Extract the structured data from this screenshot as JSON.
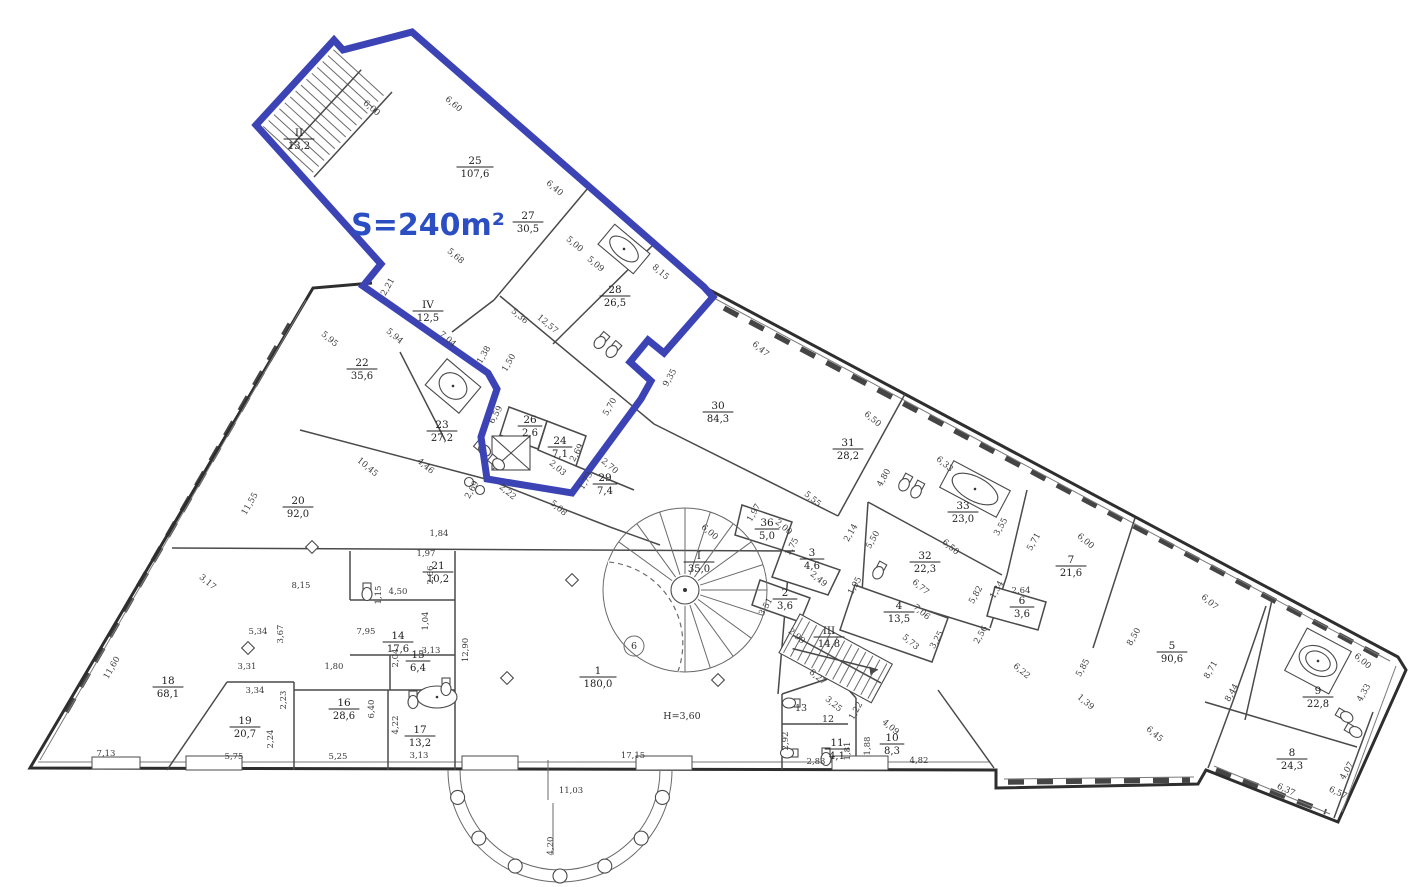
{
  "highlight": {
    "label": "S=240m²"
  },
  "colors": {
    "highlight": "#3c43b5",
    "highlight_text": "#2b4fc2",
    "walls": "#2e2e2e",
    "labels": "#222222"
  },
  "icons": [
    "spiral-staircase",
    "staircase",
    "elevator",
    "bathtub",
    "toilet",
    "sink",
    "column",
    "colonnade"
  ],
  "rooms": [
    {
      "num": "II",
      "area": "13,2",
      "x": 299,
      "y": 140
    },
    {
      "num": "25",
      "area": "107,6",
      "x": 475,
      "y": 168
    },
    {
      "num": "27",
      "area": "30,5",
      "x": 528,
      "y": 223
    },
    {
      "num": "28",
      "area": "26,5",
      "x": 615,
      "y": 297
    },
    {
      "num": "IV",
      "area": "12,5",
      "x": 428,
      "y": 312
    },
    {
      "num": "22",
      "area": "35,6",
      "x": 362,
      "y": 370
    },
    {
      "num": "23",
      "area": "27,2",
      "x": 442,
      "y": 432
    },
    {
      "num": "26",
      "area": "2,6",
      "x": 530,
      "y": 427
    },
    {
      "num": "24",
      "area": "7,1",
      "x": 560,
      "y": 448
    },
    {
      "num": "29",
      "area": "7,4",
      "x": 605,
      "y": 485
    },
    {
      "num": "30",
      "area": "84,3",
      "x": 718,
      "y": 413
    },
    {
      "num": "31",
      "area": "28,2",
      "x": 848,
      "y": 450
    },
    {
      "num": "33",
      "area": "23,0",
      "x": 963,
      "y": 513
    },
    {
      "num": "32",
      "area": "22,3",
      "x": 925,
      "y": 563
    },
    {
      "num": "7",
      "area": "21,6",
      "x": 1071,
      "y": 567
    },
    {
      "num": "6",
      "area": "3,6",
      "x": 1022,
      "y": 608
    },
    {
      "num": "4",
      "area": "13,5",
      "x": 899,
      "y": 613
    },
    {
      "num": "5",
      "area": "90,6",
      "x": 1172,
      "y": 653
    },
    {
      "num": "9",
      "area": "22,8",
      "x": 1318,
      "y": 698
    },
    {
      "num": "8",
      "area": "24,3",
      "x": 1292,
      "y": 760
    },
    {
      "num": "3",
      "area": "4,6",
      "x": 812,
      "y": 560
    },
    {
      "num": "2",
      "area": "3,6",
      "x": 785,
      "y": 600
    },
    {
      "num": "36",
      "area": "5,0",
      "x": 767,
      "y": 530
    },
    {
      "num": "I",
      "area": "35,0",
      "x": 699,
      "y": 563
    },
    {
      "num": "III",
      "area": "14,8",
      "x": 829,
      "y": 638
    },
    {
      "num": "1",
      "area": "180,0",
      "x": 598,
      "y": 678
    },
    {
      "num": "20",
      "area": "92,0",
      "x": 298,
      "y": 508
    },
    {
      "num": "21",
      "area": "10,2",
      "x": 438,
      "y": 573
    },
    {
      "num": "14",
      "area": "17,6",
      "x": 398,
      "y": 643
    },
    {
      "num": "15",
      "area": "6,4",
      "x": 418,
      "y": 662
    },
    {
      "num": "18",
      "area": "68,1",
      "x": 168,
      "y": 688
    },
    {
      "num": "19",
      "area": "20,7",
      "x": 245,
      "y": 728
    },
    {
      "num": "16",
      "area": "28,6",
      "x": 344,
      "y": 710
    },
    {
      "num": "17",
      "area": "13,2",
      "x": 420,
      "y": 737
    },
    {
      "num": "11",
      "area": "4,1",
      "x": 837,
      "y": 750
    },
    {
      "num": "10",
      "area": "8,3",
      "x": 892,
      "y": 745
    }
  ],
  "small_labels": [
    {
      "t": "12",
      "x": 828,
      "y": 722,
      "r": 0,
      "circled": false
    },
    {
      "t": "13",
      "x": 801,
      "y": 711,
      "r": 0,
      "circled": false
    },
    {
      "t": "6",
      "x": 634,
      "y": 649,
      "r": 0,
      "circled": true
    },
    {
      "t": "H=3,60",
      "x": 682,
      "y": 719,
      "r": 0,
      "circled": false
    }
  ],
  "dims": [
    {
      "t": "6,00",
      "x": 370,
      "y": 110,
      "r": 40
    },
    {
      "t": "6,60",
      "x": 452,
      "y": 106,
      "r": 40
    },
    {
      "t": "6,40",
      "x": 553,
      "y": 190,
      "r": 40
    },
    {
      "t": "5,00",
      "x": 573,
      "y": 246,
      "r": 40
    },
    {
      "t": "5,09",
      "x": 594,
      "y": 266,
      "r": 40
    },
    {
      "t": "8,15",
      "x": 659,
      "y": 274,
      "r": 40
    },
    {
      "t": "5,68",
      "x": 454,
      "y": 258,
      "r": 40
    },
    {
      "t": "2,21",
      "x": 390,
      "y": 288,
      "r": -60
    },
    {
      "t": "5,95",
      "x": 328,
      "y": 341,
      "r": 40
    },
    {
      "t": "5,94",
      "x": 393,
      "y": 338,
      "r": 40
    },
    {
      "t": "7,04",
      "x": 446,
      "y": 341,
      "r": 40
    },
    {
      "t": "1,38",
      "x": 486,
      "y": 356,
      "r": -60
    },
    {
      "t": "1,50",
      "x": 511,
      "y": 364,
      "r": -60
    },
    {
      "t": "5,36",
      "x": 518,
      "y": 318,
      "r": 40
    },
    {
      "t": "12,57",
      "x": 546,
      "y": 326,
      "r": 40
    },
    {
      "t": "9,35",
      "x": 672,
      "y": 379,
      "r": -60
    },
    {
      "t": "5,70",
      "x": 612,
      "y": 408,
      "r": -60
    },
    {
      "t": "6,59",
      "x": 498,
      "y": 416,
      "r": -60
    },
    {
      "t": "2,69",
      "x": 579,
      "y": 454,
      "r": -60
    },
    {
      "t": "2,03",
      "x": 556,
      "y": 470,
      "r": 40
    },
    {
      "t": "2,70",
      "x": 608,
      "y": 468,
      "r": 40
    },
    {
      "t": "1,73",
      "x": 588,
      "y": 482,
      "r": -60
    },
    {
      "t": "2,22",
      "x": 506,
      "y": 494,
      "r": 40
    },
    {
      "t": "2,69",
      "x": 474,
      "y": 491,
      "r": -60
    },
    {
      "t": "5,08",
      "x": 557,
      "y": 510,
      "r": 40
    },
    {
      "t": "10,45",
      "x": 366,
      "y": 469,
      "r": 40
    },
    {
      "t": "4,46",
      "x": 424,
      "y": 468,
      "r": 40
    },
    {
      "t": "11,55",
      "x": 252,
      "y": 505,
      "r": -60
    },
    {
      "t": "3,17",
      "x": 206,
      "y": 584,
      "r": 40
    },
    {
      "t": "8,15",
      "x": 301,
      "y": 588,
      "r": 0
    },
    {
      "t": "5,34",
      "x": 258,
      "y": 634,
      "r": 0
    },
    {
      "t": "7,95",
      "x": 366,
      "y": 634,
      "r": 0
    },
    {
      "t": "1,15",
      "x": 381,
      "y": 595,
      "r": -90
    },
    {
      "t": "1,84",
      "x": 439,
      "y": 536,
      "r": 0
    },
    {
      "t": "1,97",
      "x": 426,
      "y": 556,
      "r": 0
    },
    {
      "t": "2,66",
      "x": 433,
      "y": 575,
      "r": -90
    },
    {
      "t": "4,50",
      "x": 398,
      "y": 594,
      "r": 0
    },
    {
      "t": "3,67",
      "x": 283,
      "y": 634,
      "r": -90
    },
    {
      "t": "1,04",
      "x": 428,
      "y": 621,
      "r": -90
    },
    {
      "t": "3,31",
      "x": 247,
      "y": 669,
      "r": 0
    },
    {
      "t": "3,34",
      "x": 255,
      "y": 693,
      "r": 0
    },
    {
      "t": "2,23",
      "x": 286,
      "y": 700,
      "r": -90
    },
    {
      "t": "1,80",
      "x": 334,
      "y": 669,
      "r": 0
    },
    {
      "t": "2,04",
      "x": 398,
      "y": 658,
      "r": -90
    },
    {
      "t": "3,13",
      "x": 431,
      "y": 653,
      "r": 0
    },
    {
      "t": "6,40",
      "x": 374,
      "y": 709,
      "r": -90
    },
    {
      "t": "4,22",
      "x": 398,
      "y": 725,
      "r": -90
    },
    {
      "t": "11,60",
      "x": 114,
      "y": 669,
      "r": -60
    },
    {
      "t": "7,13",
      "x": 106,
      "y": 756,
      "r": 0
    },
    {
      "t": "5,75",
      "x": 234,
      "y": 759,
      "r": 0
    },
    {
      "t": "5,25",
      "x": 338,
      "y": 759,
      "r": 0
    },
    {
      "t": "3,13",
      "x": 419,
      "y": 758,
      "r": 0
    },
    {
      "t": "2,24",
      "x": 273,
      "y": 739,
      "r": -90
    },
    {
      "t": "17,15",
      "x": 633,
      "y": 758,
      "r": 0
    },
    {
      "t": "11,03",
      "x": 571,
      "y": 793,
      "r": 0
    },
    {
      "t": "4,20",
      "x": 553,
      "y": 846,
      "r": -90
    },
    {
      "t": "12,90",
      "x": 468,
      "y": 650,
      "r": -90
    },
    {
      "t": "6,00",
      "x": 708,
      "y": 534,
      "r": 40
    },
    {
      "t": "8,27",
      "x": 816,
      "y": 679,
      "r": 40
    },
    {
      "t": "6,22",
      "x": 1020,
      "y": 673,
      "r": 40
    },
    {
      "t": "2,92",
      "x": 788,
      "y": 741,
      "r": -90
    },
    {
      "t": "2,83",
      "x": 816,
      "y": 764,
      "r": 0
    },
    {
      "t": "1,81",
      "x": 850,
      "y": 751,
      "r": -90
    },
    {
      "t": "1,88",
      "x": 870,
      "y": 746,
      "r": -90
    },
    {
      "t": "4,09",
      "x": 889,
      "y": 729,
      "r": 40
    },
    {
      "t": "4,82",
      "x": 919,
      "y": 763,
      "r": 0
    },
    {
      "t": "3,25",
      "x": 832,
      "y": 706,
      "r": 40
    },
    {
      "t": "1,22",
      "x": 858,
      "y": 712,
      "r": -60
    },
    {
      "t": "6,47",
      "x": 759,
      "y": 351,
      "r": 40
    },
    {
      "t": "6,50",
      "x": 871,
      "y": 421,
      "r": 40
    },
    {
      "t": "6,33",
      "x": 943,
      "y": 466,
      "r": 40
    },
    {
      "t": "3,55",
      "x": 1003,
      "y": 528,
      "r": -60
    },
    {
      "t": "5,71",
      "x": 1036,
      "y": 543,
      "r": -60
    },
    {
      "t": "6,00",
      "x": 1084,
      "y": 543,
      "r": 40
    },
    {
      "t": "6,07",
      "x": 1208,
      "y": 604,
      "r": 40
    },
    {
      "t": "6,00",
      "x": 1361,
      "y": 663,
      "r": 40
    },
    {
      "t": "4,33",
      "x": 1366,
      "y": 694,
      "r": -60
    },
    {
      "t": "5,55",
      "x": 811,
      "y": 501,
      "r": 40
    },
    {
      "t": "4,80",
      "x": 886,
      "y": 479,
      "r": -60
    },
    {
      "t": "2,14",
      "x": 853,
      "y": 534,
      "r": -60
    },
    {
      "t": "5,50",
      "x": 875,
      "y": 541,
      "r": -60
    },
    {
      "t": "6,50",
      "x": 949,
      "y": 549,
      "r": 40
    },
    {
      "t": "6,77",
      "x": 919,
      "y": 589,
      "r": 40
    },
    {
      "t": "7,06",
      "x": 920,
      "y": 614,
      "r": 40
    },
    {
      "t": "5,73",
      "x": 909,
      "y": 644,
      "r": 40
    },
    {
      "t": "3,25",
      "x": 939,
      "y": 641,
      "r": -60
    },
    {
      "t": "2,56",
      "x": 983,
      "y": 636,
      "r": -60
    },
    {
      "t": "5,82",
      "x": 978,
      "y": 596,
      "r": -60
    },
    {
      "t": "1,34",
      "x": 999,
      "y": 591,
      "r": -60
    },
    {
      "t": "2,64",
      "x": 1021,
      "y": 593,
      "r": 0
    },
    {
      "t": "3,51",
      "x": 768,
      "y": 608,
      "r": -60
    },
    {
      "t": "2,49",
      "x": 817,
      "y": 581,
      "r": 40
    },
    {
      "t": "1,95",
      "x": 857,
      "y": 587,
      "r": -60
    },
    {
      "t": "2,99",
      "x": 795,
      "y": 638,
      "r": 40
    },
    {
      "t": "1,75",
      "x": 794,
      "y": 548,
      "r": -60
    },
    {
      "t": "2,00",
      "x": 782,
      "y": 529,
      "r": 40
    },
    {
      "t": "1,97",
      "x": 756,
      "y": 514,
      "r": -60
    },
    {
      "t": "8,50",
      "x": 1136,
      "y": 638,
      "r": -60
    },
    {
      "t": "8,71",
      "x": 1213,
      "y": 671,
      "r": -60
    },
    {
      "t": "8,44",
      "x": 1234,
      "y": 694,
      "r": -60
    },
    {
      "t": "5,85",
      "x": 1085,
      "y": 669,
      "r": -60
    },
    {
      "t": "1,39",
      "x": 1084,
      "y": 704,
      "r": 40
    },
    {
      "t": "6,45",
      "x": 1153,
      "y": 736,
      "r": 40
    },
    {
      "t": "6,37",
      "x": 1285,
      "y": 792,
      "r": 25
    },
    {
      "t": "4,07",
      "x": 1349,
      "y": 772,
      "r": -60
    },
    {
      "t": "6,57",
      "x": 1337,
      "y": 795,
      "r": 25
    }
  ]
}
